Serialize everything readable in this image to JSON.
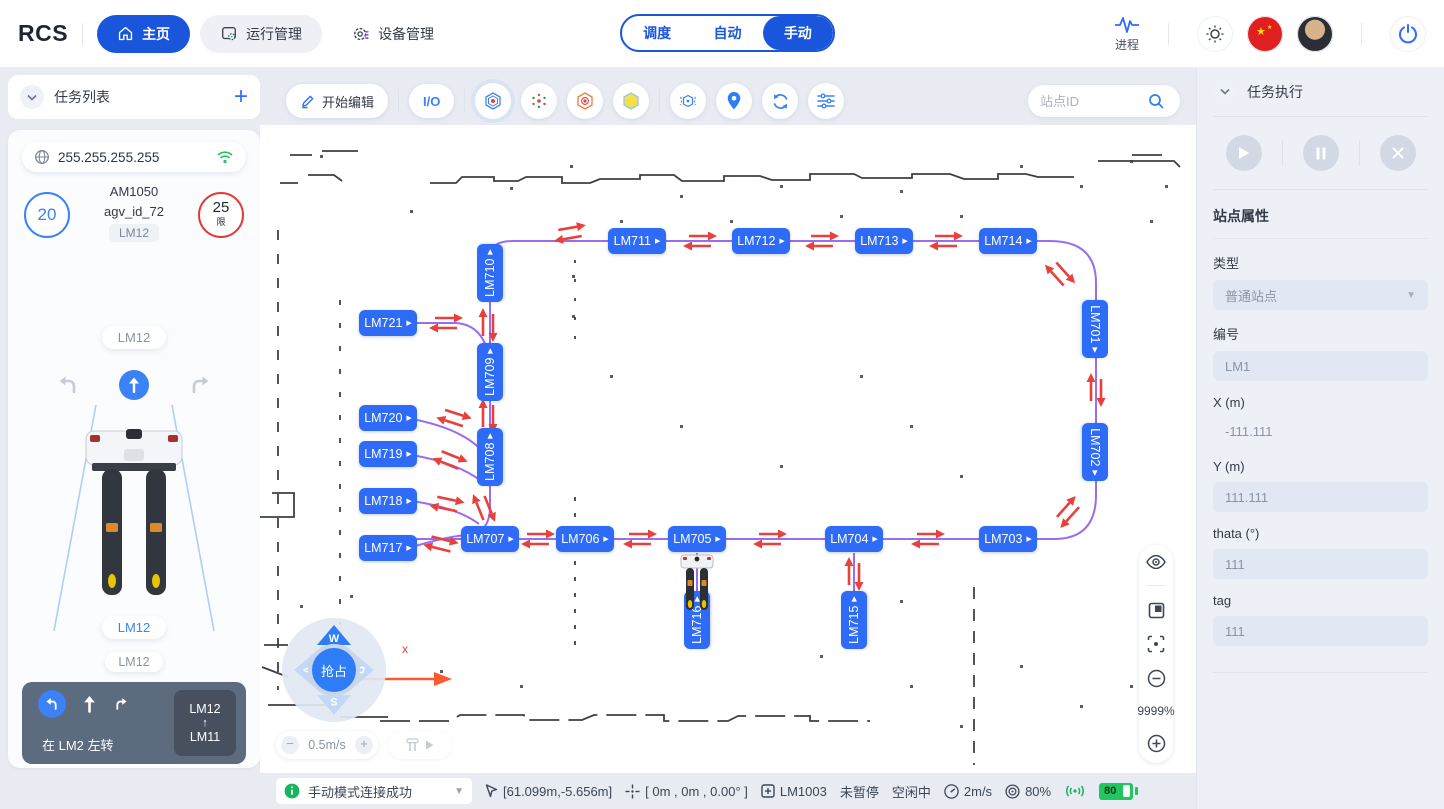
{
  "navbar": {
    "logo": "RCS",
    "items": [
      {
        "label": "主页"
      },
      {
        "label": "运行管理"
      },
      {
        "label": "设备管理"
      }
    ],
    "mode_tabs": [
      {
        "label": "调度"
      },
      {
        "label": "自动"
      },
      {
        "label": "手动"
      }
    ],
    "process_label": "进程"
  },
  "left_panel": {
    "title": "任务列表",
    "ip": "255.255.255.255",
    "speed_value": "20",
    "limit_value": "25",
    "limit_tag": "限",
    "model": "AM1050",
    "agv_id": "agv_id_72",
    "tag_small": "LM12",
    "tag_pill": "LM12",
    "front_tag": "LM12",
    "front_tag2": "LM12",
    "nav_from": "LM12",
    "nav_arrow": "↑",
    "nav_to": "LM11",
    "nav_instruction": "在 LM2 左转",
    "stats": [
      {
        "top": "25 km",
        "bottom": "650 km"
      },
      {
        "top": "5 h",
        "bottom": "850 h"
      }
    ]
  },
  "map": {
    "toolbar": {
      "edit_label": "开始编辑",
      "io_label": "I/O",
      "search_placeholder": "站点ID"
    },
    "zoom_percent": "9999%",
    "joystick": {
      "up": "W",
      "left": "A",
      "right": "D",
      "down": "S",
      "center": "抢占"
    },
    "speed_label": "0.5m/s",
    "axis_label": "x",
    "stations": [
      {
        "id": "LM711",
        "x": 377,
        "y": 116,
        "o": "h"
      },
      {
        "id": "LM712",
        "x": 501,
        "y": 116,
        "o": "h"
      },
      {
        "id": "LM713",
        "x": 624,
        "y": 116,
        "o": "h"
      },
      {
        "id": "LM714",
        "x": 748,
        "y": 116,
        "o": "h"
      },
      {
        "id": "LM710",
        "x": 230,
        "y": 148,
        "o": "v-up"
      },
      {
        "id": "LM721",
        "x": 128,
        "y": 198,
        "o": "h"
      },
      {
        "id": "LM709",
        "x": 230,
        "y": 247,
        "o": "v-up"
      },
      {
        "id": "LM720",
        "x": 128,
        "y": 293,
        "o": "h"
      },
      {
        "id": "LM719",
        "x": 128,
        "y": 329,
        "o": "h"
      },
      {
        "id": "LM708",
        "x": 230,
        "y": 332,
        "o": "v-up"
      },
      {
        "id": "LM718",
        "x": 128,
        "y": 376,
        "o": "h"
      },
      {
        "id": "LM717",
        "x": 128,
        "y": 423,
        "o": "h"
      },
      {
        "id": "LM707",
        "x": 230,
        "y": 414,
        "o": "h"
      },
      {
        "id": "LM706",
        "x": 325,
        "y": 414,
        "o": "h"
      },
      {
        "id": "LM705",
        "x": 437,
        "y": 414,
        "o": "h"
      },
      {
        "id": "LM704",
        "x": 594,
        "y": 414,
        "o": "h"
      },
      {
        "id": "LM703",
        "x": 748,
        "y": 414,
        "o": "h"
      },
      {
        "id": "LM701",
        "x": 835,
        "y": 204,
        "o": "v-down"
      },
      {
        "id": "LM702",
        "x": 835,
        "y": 327,
        "o": "v-down"
      },
      {
        "id": "LM716",
        "x": 437,
        "y": 495,
        "o": "v-up"
      },
      {
        "id": "LM715",
        "x": 594,
        "y": 495,
        "o": "v-up"
      }
    ],
    "statusbar": {
      "message": "手动模式连接成功",
      "cursor_pos": "[61.099m,-5.656m]",
      "pose": "[ 0m , 0m , 0.00° ]",
      "station_id": "LM1003",
      "pause_state": "未暂停",
      "work_state": "空闲中",
      "speed": "2m/s",
      "percent": "80%",
      "battery": "80"
    }
  },
  "right_panel": {
    "title": "任务执行",
    "section_title": "站点属性",
    "fields": [
      {
        "label": "类型",
        "value": "普通站点"
      },
      {
        "label": "编号",
        "value": "LM1"
      },
      {
        "label": "X (m)",
        "value": "-111.111"
      },
      {
        "label": "Y (m)",
        "value": "111.111"
      },
      {
        "label": "thata (°)",
        "value": "111"
      },
      {
        "label": "tag",
        "value": "111"
      }
    ]
  }
}
